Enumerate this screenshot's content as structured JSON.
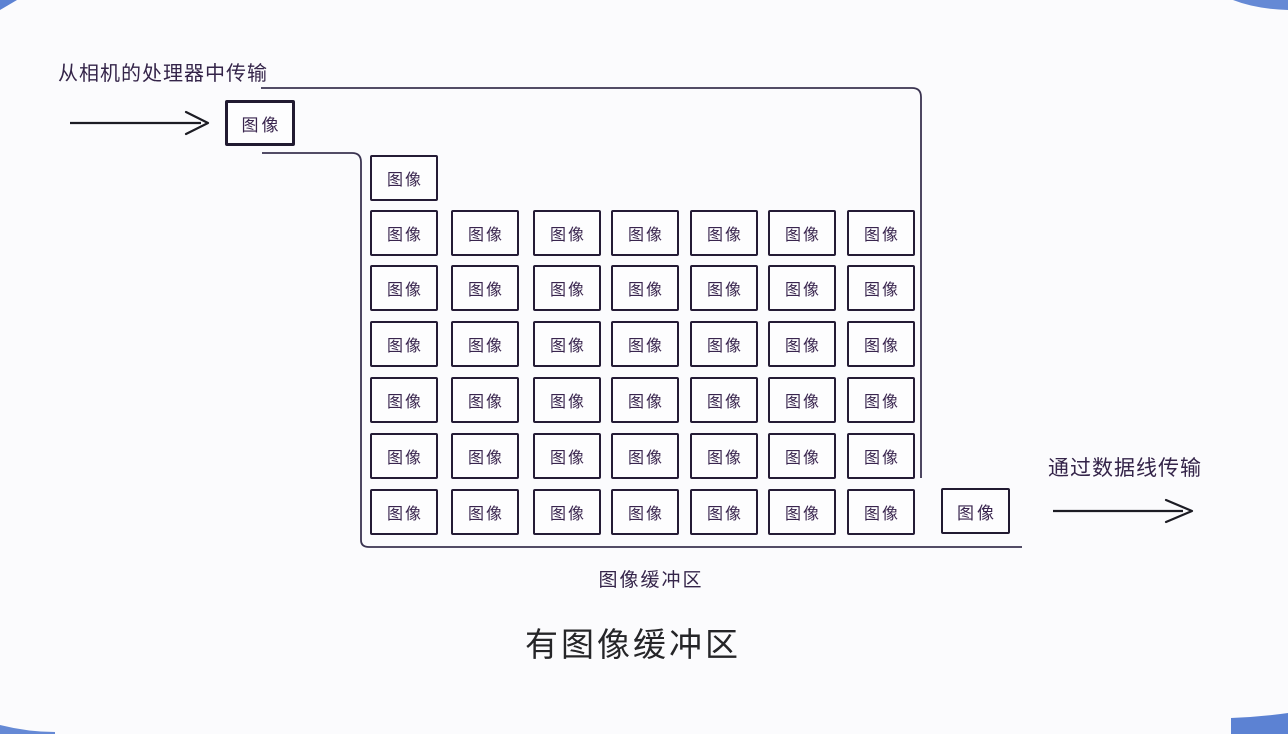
{
  "page": {
    "background": "#fbfbfd",
    "ink": "#3a3350",
    "box_border": "#211a31",
    "arrow_color": "#1c1c24",
    "title_color": "#252528",
    "accent_blue": "#4a74ce"
  },
  "labels": {
    "from_camera": "从相机的处理器中传输",
    "via_cable": "通过数据线传输",
    "buffer_caption": "图像缓冲区",
    "title": "有图像缓冲区"
  },
  "incoming_box": {
    "label": "图像"
  },
  "outgoing_box": {
    "label": "图像"
  },
  "buffer": {
    "cell_label": "图像",
    "rows": 7,
    "cols": 7,
    "top_row_cells": 1,
    "bottom_row_has_exiting_cell": true,
    "total_cells_inside": 43
  },
  "icons": {
    "incoming_arrow": "arrow-right",
    "outgoing_arrow": "arrow-right"
  }
}
